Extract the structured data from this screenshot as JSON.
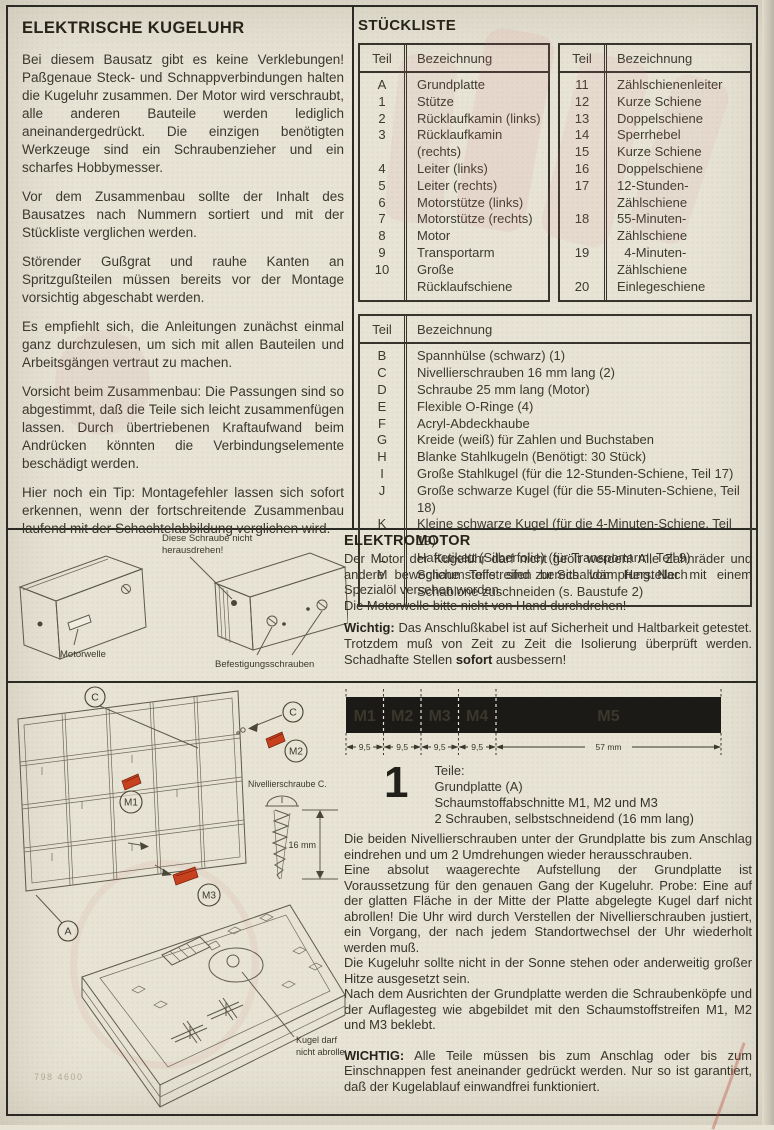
{
  "doc": {
    "intro": {
      "title": "ELEKTRISCHE KUGELUHR",
      "paragraphs": [
        "Bei diesem Bausatz gibt es keine Verklebungen! Paßgenaue Steck- und Schnappverbindungen halten die Kugeluhr zusammen. Der Motor wird verschraubt, alle anderen Bauteile werden lediglich aneinandergedrückt. Die einzigen benötigten Werkzeuge sind ein Schraubenzieher und ein scharfes Hobbymesser.",
        "Vor dem Zusammenbau sollte der Inhalt des Bausatzes nach Nummern sortiert und mit der Stückliste verglichen werden.",
        "Störender Gußgrat und rauhe Kanten an Spritzgußteilen müssen bereits vor der Montage vorsichtig abgeschabt werden.",
        "Es empfiehlt sich, die Anleitungen zunächst einmal ganz durchzulesen, um sich mit allen Bauteilen und Arbeitsgängen vertraut zu machen.",
        "Vorsicht beim Zusammenbau: Die Passungen sind so abgestimmt, daß die Teile sich leicht zusammenfügen lassen. Durch übertriebenen Kraftaufwand beim Andrücken könnten die Verbindungselemente beschädigt werden.",
        "Hier noch ein Tip: Montagefehler lassen sich sofort erkennen, wenn der fortschreitende Zusammenbau laufend mit der Schachtelabbildung verglichen wird."
      ]
    },
    "stueckliste": {
      "title": "STÜCKLISTE",
      "headers": {
        "teil": "Teil",
        "bezeichnung": "Bezeichnung"
      },
      "table_a": [
        {
          "teil": "A",
          "bez": "Grundplatte"
        },
        {
          "teil": "1",
          "bez": "Stütze"
        },
        {
          "teil": "2",
          "bez": "Rücklaufkamin (links)"
        },
        {
          "teil": "3",
          "bez": "Rücklaufkamin (rechts)"
        },
        {
          "teil": "4",
          "bez": "Leiter (links)"
        },
        {
          "teil": "5",
          "bez": "Leiter (rechts)"
        },
        {
          "teil": "6",
          "bez": "Motorstütze (links)"
        },
        {
          "teil": "7",
          "bez": "Motorstütze (rechts)"
        },
        {
          "teil": "8",
          "bez": "Motor"
        },
        {
          "teil": "9",
          "bez": "Transportarm"
        },
        {
          "teil": "10",
          "bez": "Große Rücklaufschiene"
        }
      ],
      "table_b": [
        {
          "teil": "11",
          "bez": "Zählschienenleiter"
        },
        {
          "teil": "12",
          "bez": "Kurze Schiene"
        },
        {
          "teil": "13",
          "bez": "Doppelschiene"
        },
        {
          "teil": "14",
          "bez": "Sperrhebel"
        },
        {
          "teil": "15",
          "bez": "Kurze Schiene"
        },
        {
          "teil": "16",
          "bez": "Doppelschiene"
        },
        {
          "teil": "17",
          "bez": "12-Stunden-Zählschiene"
        },
        {
          "teil": "18",
          "bez": "55-Minuten-Zählschiene"
        },
        {
          "teil": "19",
          "bez": "  4-Minuten-Zählschiene"
        },
        {
          "teil": "20",
          "bez": "Einlegeschiene"
        }
      ],
      "table_c": [
        {
          "teil": "B",
          "bez": "Spannhülse (schwarz) (1)"
        },
        {
          "teil": "C",
          "bez": "Nivellierschrauben 16 mm lang (2)"
        },
        {
          "teil": "D",
          "bez": "Schraube 25 mm lang (Motor)"
        },
        {
          "teil": "E",
          "bez": "Flexible O-Ringe (4)"
        },
        {
          "teil": "F",
          "bez": "Acryl-Abdeckhaube"
        },
        {
          "teil": "G",
          "bez": "Kreide (weiß) für Zahlen und Buchstaben"
        },
        {
          "teil": "H",
          "bez": "Blanke Stahlkugeln (Benötigt: 30 Stück)"
        },
        {
          "teil": "I",
          "bez": "Große Stahlkugel (für die 12-Stunden-Schiene, Teil 17)"
        },
        {
          "teil": "J",
          "bez": "Große schwarze Kugel (für die 55-Minuten-Schiene, Teil 18)"
        },
        {
          "teil": "K",
          "bez": "Kleine schwarze Kugel (für die 4-Minuten-Schiene, Teil 19)"
        },
        {
          "teil": "L",
          "bez": "Haftetikett (Silberfolie) (für Transportarm, Teil 9)"
        },
        {
          "teil": "M",
          "bez": "Schaumstoffstreifen zur Schalldämpfung. Nach Schablone zuschneiden (s. Baustufe 2)"
        }
      ]
    },
    "motor_figure": {
      "warning_line1": "Diese Schraube nicht",
      "warning_line2": "herausdrehen!",
      "shaft_label": "Motorwelle",
      "screws_label": "Befestigungsschrauben"
    },
    "elektromotor": {
      "title": "ELEKTROMOTOR",
      "p1": "Der Motor der Kugeluhr darf nicht geölt werden! Alle Zahnräder und andere bewegliche Teile sind bereits vom Hersteller mit einem Spezialöl versehen worden.",
      "p2": "Die Motorwelle bitte nicht von Hand durchdrehen!",
      "wichtig_label": "Wichtig:",
      "wichtig_before": " Das Anschlußkabel ist auf Sicherheit und Haltbarkeit getestet. Trotzdem muß von Zeit zu Zeit die Isolierung überprüft werden. Schadhafte Stellen ",
      "wichtig_bold": "sofort",
      "wichtig_after": " ausbessern!"
    },
    "foam_bar": {
      "segments": [
        {
          "label": "M1",
          "dim": "9,5"
        },
        {
          "label": "M2",
          "dim": "9,5"
        },
        {
          "label": "M3",
          "dim": "9,5"
        },
        {
          "label": "M4",
          "dim": "9,5"
        },
        {
          "label": "M5",
          "dim": "57 mm"
        }
      ]
    },
    "step1": {
      "number": "1",
      "parts_title": "Teile:",
      "parts": [
        "Grundplatte (A)",
        "Schaumstoffabschnitte M1, M2 und M3",
        "2 Schrauben, selbstschneidend (16 mm lang)"
      ],
      "paragraphs": [
        "Die beiden Nivellierschrauben unter der Grundplatte bis zum Anschlag eindrehen und um 2 Umdrehungen wieder herausschrauben.",
        "Eine absolut waagerechte Aufstellung der Grundplatte ist Voraussetzung für den genauen Gang der Kugeluhr. Probe: Eine auf der glatten Fläche in der Mitte der Platte abgelegte Kugel darf nicht abrollen! Die Uhr wird durch Verstellen der Nivellierschrauben justiert, ein Vorgang, der nach jedem Standortwechsel der Uhr wiederholt werden muß.",
        "Die Kugeluhr sollte nicht in der Sonne stehen oder anderweitig großer Hitze ausgesetzt sein.",
        "Nach dem Ausrichten der Grundplatte werden die Schraubenköpfe und der Auflagesteg wie abgebildet mit den Schaumstoffstreifen M1, M2 und M3 beklebt."
      ],
      "wichtig_label": "WICHTIG:",
      "wichtig_text": " Alle Teile müssen bis zum Anschlag oder bis zum Einschnappen fest aneinander gedrückt werden. Nur so ist garantiert, daß der Kugelablauf einwandfrei funktioniert."
    },
    "base_figure": {
      "c_top": "C",
      "c_right": "C",
      "m1": "M1",
      "m2": "M2",
      "m3": "M3",
      "a": "A",
      "screw_label": "Nivellierschraube C.",
      "screw_dim": "16 mm",
      "kugel_line1": "Kugel darf",
      "kugel_line2": "nicht abrollen!",
      "print_code": "798 4600"
    }
  }
}
